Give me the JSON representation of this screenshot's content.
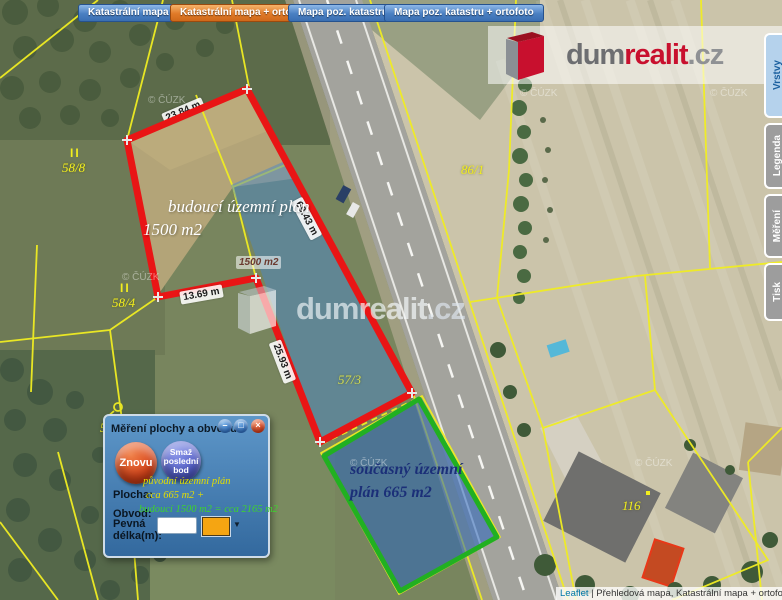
{
  "toolbar": {
    "buttons": [
      {
        "label": "Katastrální mapa",
        "active": false
      },
      {
        "label": "Katastrální mapa + ortofoto",
        "active": true
      },
      {
        "label": "Mapa poz. katastru",
        "active": false
      },
      {
        "label": "Mapa poz. katastru + ortofoto",
        "active": false
      }
    ]
  },
  "brand": {
    "dum": "dum",
    "realit": "realit",
    "cz": ".cz"
  },
  "side_tabs": {
    "layers": "Vrstvy",
    "legend": "Legenda",
    "measure": "Měření",
    "print": "Tisk"
  },
  "map": {
    "copyright": "© ČÚZK",
    "parcel_labels": {
      "p588": "58/8",
      "p584": "58/4",
      "p861": "86/1",
      "p573": "57/3",
      "p582": "58/2",
      "p116": "116",
      "mark1": "II",
      "mark2": "II"
    },
    "measurement_labels": {
      "seg_top": "23.84 m",
      "seg_bottom": "13.69 m",
      "seg_road": "69.43 m",
      "seg_inner": "25.93 m",
      "area_chip": "1500 m2"
    },
    "annotation_future": {
      "line1": "budoucí územní plán",
      "line2": "1500 m2"
    },
    "annotation_current": {
      "line1": "současný územní",
      "line2": "plán 665 m2"
    }
  },
  "dialog": {
    "title": "Měření plochy a obvodu",
    "window_buttons": {
      "minimize": "–",
      "maximize": "□",
      "close": "×"
    },
    "redo_button": "Znovu",
    "delete_button": "Smaž poslední bod",
    "area_label": "Plocha:",
    "perimeter_label": "Obvod:",
    "fixed_length_label": "Pevná délka(m):",
    "dropdown_arrow": "▼",
    "annotation": {
      "line1": "původní územní plán",
      "line2": "cca 665 m2 +",
      "line3": "budoucí 1500 m2 = cca 2165 m2"
    }
  },
  "attribution": {
    "leaflet": "Leaflet",
    "text": "| Přehledová mapa, Katastrální mapa + ortofoto, orto"
  }
}
